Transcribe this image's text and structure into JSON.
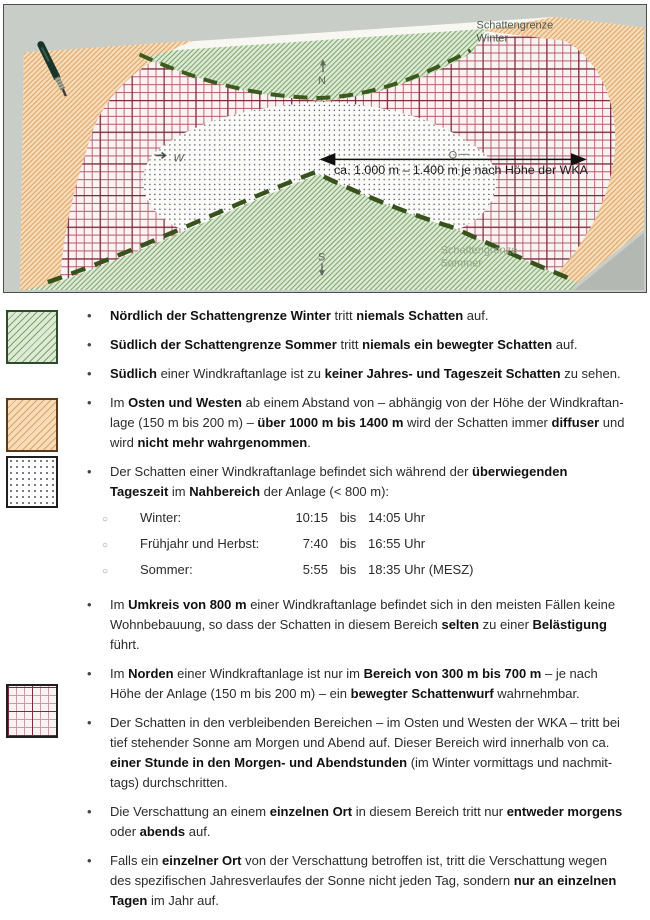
{
  "diagram": {
    "winter_boundary_label_line1": "Schattengrenze",
    "winter_boundary_label_line2": "Winter",
    "summer_boundary_label_line1": "Schattengrenze",
    "summer_boundary_label_line2": "Sommer",
    "distance_arrow_label": "ca. 1.000 m – 1.400 m je nach Höhe der WKA",
    "compass": {
      "north": "N",
      "south": "S",
      "west": "W",
      "east": "O"
    }
  },
  "legend": {
    "swatches": [
      {
        "name": "green-hatch",
        "meaning": "kein Schatten",
        "line_color": "#79a468",
        "bg_color": "#dfead6"
      },
      {
        "name": "orange-hatch",
        "meaning": "diffuser Schatten",
        "line_color": "#dfa264",
        "bg_color": "#f6dcb9"
      },
      {
        "name": "dotted",
        "meaning": "Nahbereich",
        "line_color": "#4e525e",
        "bg_color": "#ffffff"
      },
      {
        "name": "red-grid",
        "meaning": "Morgen-/Abendschatten",
        "line_color": "#7c2b3d",
        "bg_color": "#fbf2f2"
      }
    ]
  },
  "shadow_times": {
    "rows": [
      {
        "label": "Winter:",
        "from": "10:15",
        "sep": "bis",
        "to": "14:05 Uhr"
      },
      {
        "label": "Frühjahr und Herbst:",
        "from": "7:40",
        "sep": "bis",
        "to": "16:55 Uhr"
      },
      {
        "label": "Sommer:",
        "from": "5:55",
        "sep": "bis",
        "to": "18:35 Uhr (MESZ)"
      }
    ]
  },
  "bullets": [
    {
      "segments": [
        {
          "t": "Nördlich der Schattengrenze Winter",
          "b": true
        },
        {
          "t": " tritt ",
          "b": false
        },
        {
          "t": "niemals Schatten",
          "b": true
        },
        {
          "t": " auf.",
          "b": false
        }
      ]
    },
    {
      "segments": [
        {
          "t": "Südlich der Schattengrenze Sommer",
          "b": true
        },
        {
          "t": " tritt ",
          "b": false
        },
        {
          "t": "niemals ein bewegter Schatten",
          "b": true
        },
        {
          "t": " auf.",
          "b": false
        }
      ]
    },
    {
      "segments": [
        {
          "t": "Südlich",
          "b": true
        },
        {
          "t": " einer Windkraftanlage ist zu ",
          "b": false
        },
        {
          "t": "keiner Jahres- und Tageszeit Schatten",
          "b": true
        },
        {
          "t": " zu sehen.",
          "b": false
        }
      ]
    },
    {
      "segments": [
        {
          "t": "Im ",
          "b": false
        },
        {
          "t": "Osten und Westen",
          "b": true
        },
        {
          "t": " ab einem Abstand von – abhängig von der Höhe der Windkraftan­lage (150 m bis 200 m) – ",
          "b": false
        },
        {
          "t": "über 1000 m bis 1400 m",
          "b": true
        },
        {
          "t": " wird der Schatten immer ",
          "b": false
        },
        {
          "t": "diffuser",
          "b": true
        },
        {
          "t": " und wird ",
          "b": false
        },
        {
          "t": "nicht mehr wahrgenommen",
          "b": true
        },
        {
          "t": ".",
          "b": false
        }
      ]
    },
    {
      "segments": [
        {
          "t": "Der Schatten einer Windkraftanlage befindet sich während der ",
          "b": false
        },
        {
          "t": "überwiegenden Tageszeit",
          "b": true
        },
        {
          "t": " im ",
          "b": false
        },
        {
          "t": "Nahbereich",
          "b": true
        },
        {
          "t": " der Anlage (< 800 m):",
          "b": false
        }
      ]
    },
    {
      "segments": [
        {
          "t": "Im ",
          "b": false
        },
        {
          "t": "Umkreis von 800 m",
          "b": true
        },
        {
          "t": " einer Windkraftanlage befindet sich in den meisten Fällen keine Wohnbebauung, so dass der Schatten in diesem Bereich ",
          "b": false
        },
        {
          "t": "selten",
          "b": true
        },
        {
          "t": " zu einer ",
          "b": false
        },
        {
          "t": "Belästigung",
          "b": true
        },
        {
          "t": " führt.",
          "b": false
        }
      ]
    },
    {
      "segments": [
        {
          "t": "Im ",
          "b": false
        },
        {
          "t": "Norden",
          "b": true
        },
        {
          "t": " einer Windkraftanlage ist nur im ",
          "b": false
        },
        {
          "t": "Bereich von 300 m bis 700 m",
          "b": true
        },
        {
          "t": " – je nach Höhe der Anlage (150 m bis 200 m) – ein ",
          "b": false
        },
        {
          "t": "bewegter Schattenwurf",
          "b": true
        },
        {
          "t": " wahrnehmbar.",
          "b": false
        }
      ]
    },
    {
      "segments": [
        {
          "t": "Der Schatten in den verbleibenden Bereichen – im Osten und Westen der WKA – tritt bei tief stehender Sonne am Morgen und Abend auf. Dieser Bereich wird innerhalb von ca. ",
          "b": false
        },
        {
          "t": "einer Stunde in den Morgen- und Abendstunden",
          "b": true
        },
        {
          "t": " (im Winter vormittags und nachmit­tags) durchschritten.",
          "b": false
        }
      ]
    },
    {
      "segments": [
        {
          "t": "Die Verschattung an einem ",
          "b": false
        },
        {
          "t": "einzelnen Ort",
          "b": true
        },
        {
          "t": " in diesem Bereich tritt nur ",
          "b": false
        },
        {
          "t": "entweder morgens",
          "b": true
        },
        {
          "t": " oder ",
          "b": false
        },
        {
          "t": "abends",
          "b": true
        },
        {
          "t": " auf.",
          "b": false
        }
      ]
    },
    {
      "segments": [
        {
          "t": "Falls ein ",
          "b": false
        },
        {
          "t": "einzelner Ort",
          "b": true
        },
        {
          "t": " von der Verschattung betroffen ist, tritt die Verschattung wegen des spezifischen Jahresverlaufes der Sonne nicht jeden Tag, sondern ",
          "b": false
        },
        {
          "t": "nur an einzelnen Tagen",
          "b": true
        },
        {
          "t": " im Jahr auf.",
          "b": false
        }
      ]
    }
  ]
}
